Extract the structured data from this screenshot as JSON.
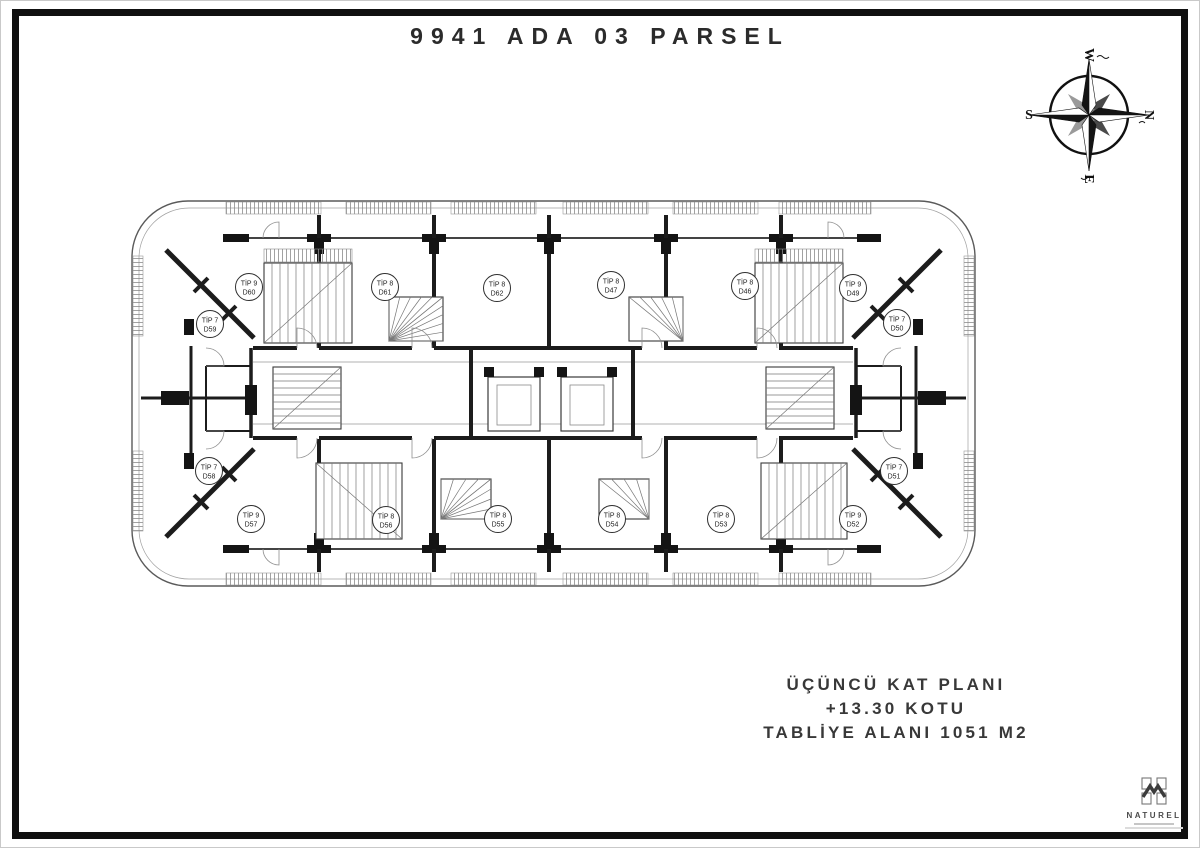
{
  "title": "9941 ADA 03 PARSEL",
  "compass": {
    "top": "W",
    "right": "N",
    "bottom": "E",
    "left": "S"
  },
  "plan": {
    "units": [
      {
        "tip": "TİP 9",
        "no": "D60",
        "x": 248,
        "y": 286
      },
      {
        "tip": "TİP 8",
        "no": "D61",
        "x": 384,
        "y": 286
      },
      {
        "tip": "TİP 8",
        "no": "D62",
        "x": 496,
        "y": 287
      },
      {
        "tip": "TİP 8",
        "no": "D47",
        "x": 610,
        "y": 284
      },
      {
        "tip": "TİP 8",
        "no": "D46",
        "x": 744,
        "y": 285
      },
      {
        "tip": "TİP 9",
        "no": "D49",
        "x": 852,
        "y": 287
      },
      {
        "tip": "TİP 7",
        "no": "D59",
        "x": 209,
        "y": 323
      },
      {
        "tip": "TİP 7",
        "no": "D50",
        "x": 896,
        "y": 322
      },
      {
        "tip": "TİP 7",
        "no": "D58",
        "x": 208,
        "y": 470
      },
      {
        "tip": "TİP 7",
        "no": "D51",
        "x": 893,
        "y": 470
      },
      {
        "tip": "TİP 9",
        "no": "D57",
        "x": 250,
        "y": 518
      },
      {
        "tip": "TİP 8",
        "no": "D56",
        "x": 385,
        "y": 519
      },
      {
        "tip": "TİP 8",
        "no": "D55",
        "x": 497,
        "y": 518
      },
      {
        "tip": "TİP 8",
        "no": "D54",
        "x": 611,
        "y": 518
      },
      {
        "tip": "TİP 8",
        "no": "D53",
        "x": 720,
        "y": 518
      },
      {
        "tip": "TİP 9",
        "no": "D52",
        "x": 852,
        "y": 518
      }
    ]
  },
  "footer": {
    "line1": "ÜÇÜNCÜ KAT PLANI",
    "line2": "+13.30 KOTU",
    "line3": "TABLİYE ALANI 1051 M2"
  },
  "logo": {
    "name": "NATUREL"
  }
}
